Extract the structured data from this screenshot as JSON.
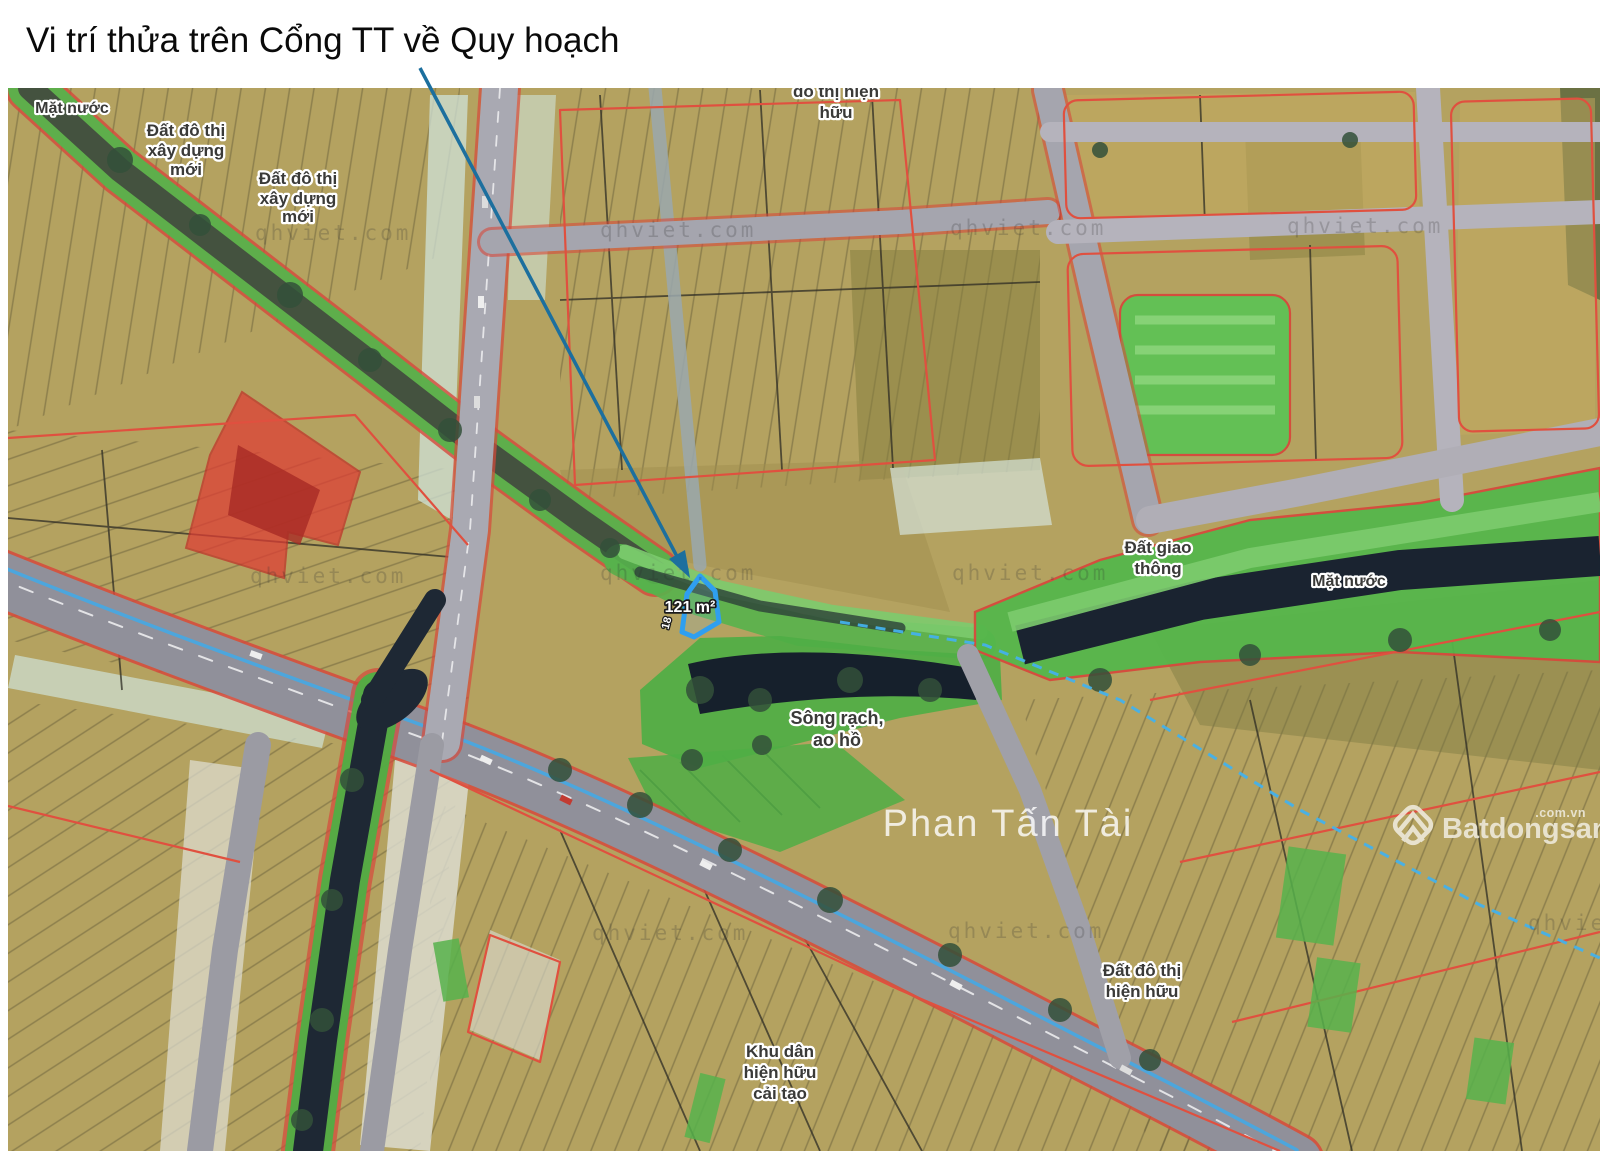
{
  "title": "Vi trí thửa trên Cổng TT về Quy hoạch",
  "parcel": {
    "area_label": "121 m²",
    "edge_dimension": "18",
    "outline_color": "#2f9ff0"
  },
  "map_labels": {
    "mat_nuoc_top": "Mặt nước",
    "dat_do_thi_moi_1": [
      "Đất đô thị",
      "xây dựng",
      "mới"
    ],
    "dat_do_thi_moi_2": [
      "Đất đô thị",
      "xây dựng",
      "mới"
    ],
    "do_thi_hien_huu_top": [
      "đô thị hiện",
      "hữu"
    ],
    "dat_giao_thong": [
      "Đất giao",
      "thông"
    ],
    "mat_nuoc_right": "Mặt nước",
    "song_rach": [
      "Sông rạch,",
      "ao hồ"
    ],
    "dat_do_thi_hien_huu": [
      "Đất đô thị",
      "hiện hữu"
    ],
    "khu_dan": [
      "Khu dân",
      "hiện hữu",
      "cải tạo"
    ],
    "street_name": "Phan Tấn Tài"
  },
  "watermarks": {
    "qhviet": "qhviet.com",
    "brand_name": "Batdongsan",
    "brand_suffix": ".com.vn"
  },
  "colors": {
    "urban_land": "#b4a260",
    "green_space": "#55b74b",
    "water_dark": "#1a2430",
    "highlight_parcel": "#2f9ff0",
    "red_zone": "#e03c34",
    "red_boundary": "#d6493c",
    "road_grey": "#96969e",
    "cyan_road_line": "#49a8e0",
    "blue_dashed_line": "#45b1ea",
    "leader_line": "#1c6f9e"
  }
}
